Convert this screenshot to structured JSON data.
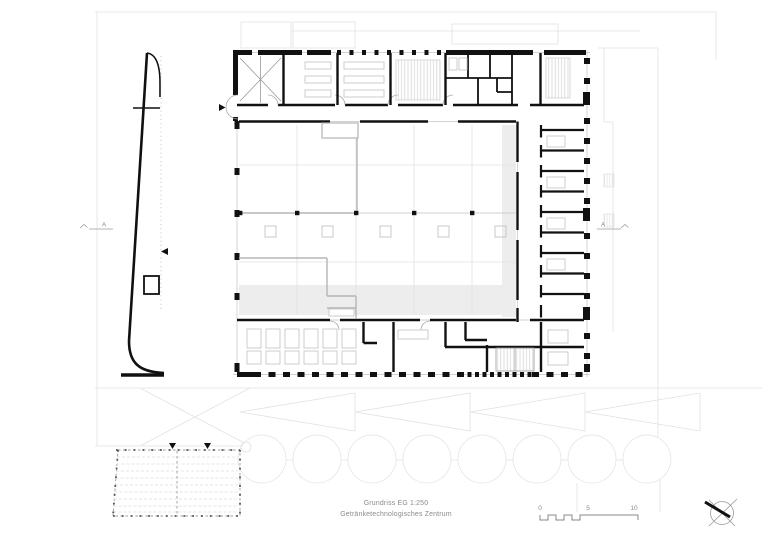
{
  "title_block": {
    "line1": "Grundriss EG 1:250",
    "line2": "Getränketechnologisches Zentrum"
  },
  "scale_bar": {
    "labels": [
      "0",
      "5",
      "10"
    ]
  },
  "section_markers": {
    "left": "A",
    "right": "A"
  },
  "icons": {
    "north_arrow": "north-arrow-compass",
    "entrance_arrow": "direction-arrow",
    "pergola_markers": "downspout-triangles"
  },
  "colors": {
    "paper": "#ffffff",
    "ink": "#111111",
    "mid": "#9a9a9a",
    "lite": "#c8c8c8",
    "faint": "#e2e2e2",
    "shade": "#ededed",
    "text": "#8a8a8a"
  }
}
